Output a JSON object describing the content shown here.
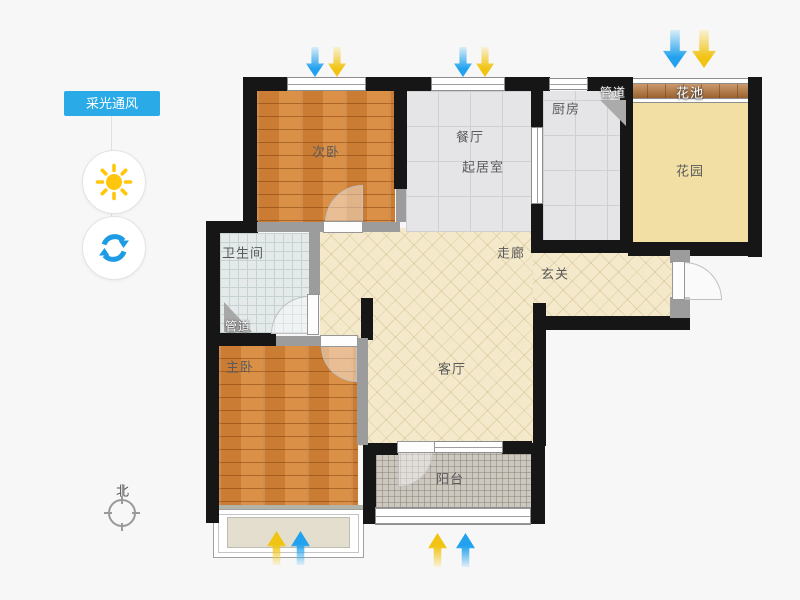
{
  "app": {
    "type": "floor-plan-viewer",
    "background": "#f7f7f7"
  },
  "sidebar": {
    "tool_tag": "采光通风",
    "controls": [
      {
        "id": "sun",
        "icon": "sun-icon",
        "color": "#ffc60b"
      },
      {
        "id": "rotate",
        "icon": "rotate-icon",
        "color": "#1d9be4"
      }
    ]
  },
  "rooms": {
    "secondary_bedroom": {
      "label": "次卧",
      "floor": "wood"
    },
    "dining": {
      "label": "餐厅",
      "floor": "tile"
    },
    "living": {
      "label": "起居室",
      "floor": "tile"
    },
    "kitchen": {
      "label": "厨房",
      "floor": "tile"
    },
    "pipe_top": {
      "label": "管道"
    },
    "flower_bed": {
      "label": "花池",
      "floor": "wood-strip"
    },
    "garden": {
      "label": "花园",
      "floor": "plain-cream"
    },
    "bathroom": {
      "label": "卫生间",
      "floor": "small-tile"
    },
    "pipe_bottom": {
      "label": "管道"
    },
    "corridor": {
      "label": "走廊",
      "floor": "hatched-cream"
    },
    "foyer": {
      "label": "玄关",
      "floor": "hatched-cream"
    },
    "master_bedroom": {
      "label": "主卧",
      "floor": "wood"
    },
    "living_room": {
      "label": "客厅",
      "floor": "hatched-cream"
    },
    "balcony": {
      "label": "阳台",
      "floor": "mosaic"
    }
  },
  "compass": {
    "north_label": "北"
  },
  "ventilation_arrows": [
    {
      "location": "secondary-bedroom-window-top",
      "direction": "down",
      "colors": [
        "blue",
        "yellow"
      ]
    },
    {
      "location": "living-window-top",
      "direction": "down",
      "colors": [
        "blue",
        "yellow"
      ]
    },
    {
      "location": "flower-bed-top",
      "direction": "down",
      "colors": [
        "blue",
        "yellow"
      ],
      "size": "large"
    },
    {
      "location": "master-bedroom-bay-bottom",
      "direction": "up",
      "colors": [
        "yellow",
        "blue"
      ]
    },
    {
      "location": "balcony-bottom",
      "direction": "up",
      "colors": [
        "yellow",
        "blue"
      ]
    }
  ],
  "colors": {
    "accent_blue": "#2aabe8",
    "arrow_blue": "#22a2ee",
    "arrow_yellow": "#f1c413",
    "wall_black": "#161616",
    "wall_gray": "#9c9c9c",
    "wood_floor": "#d5883e",
    "tile_floor": "#e5e5e7",
    "cream_floor": "#f4e9cb",
    "garden_floor": "#f1dfa4",
    "mosaic_floor": "#ccc7bf"
  }
}
